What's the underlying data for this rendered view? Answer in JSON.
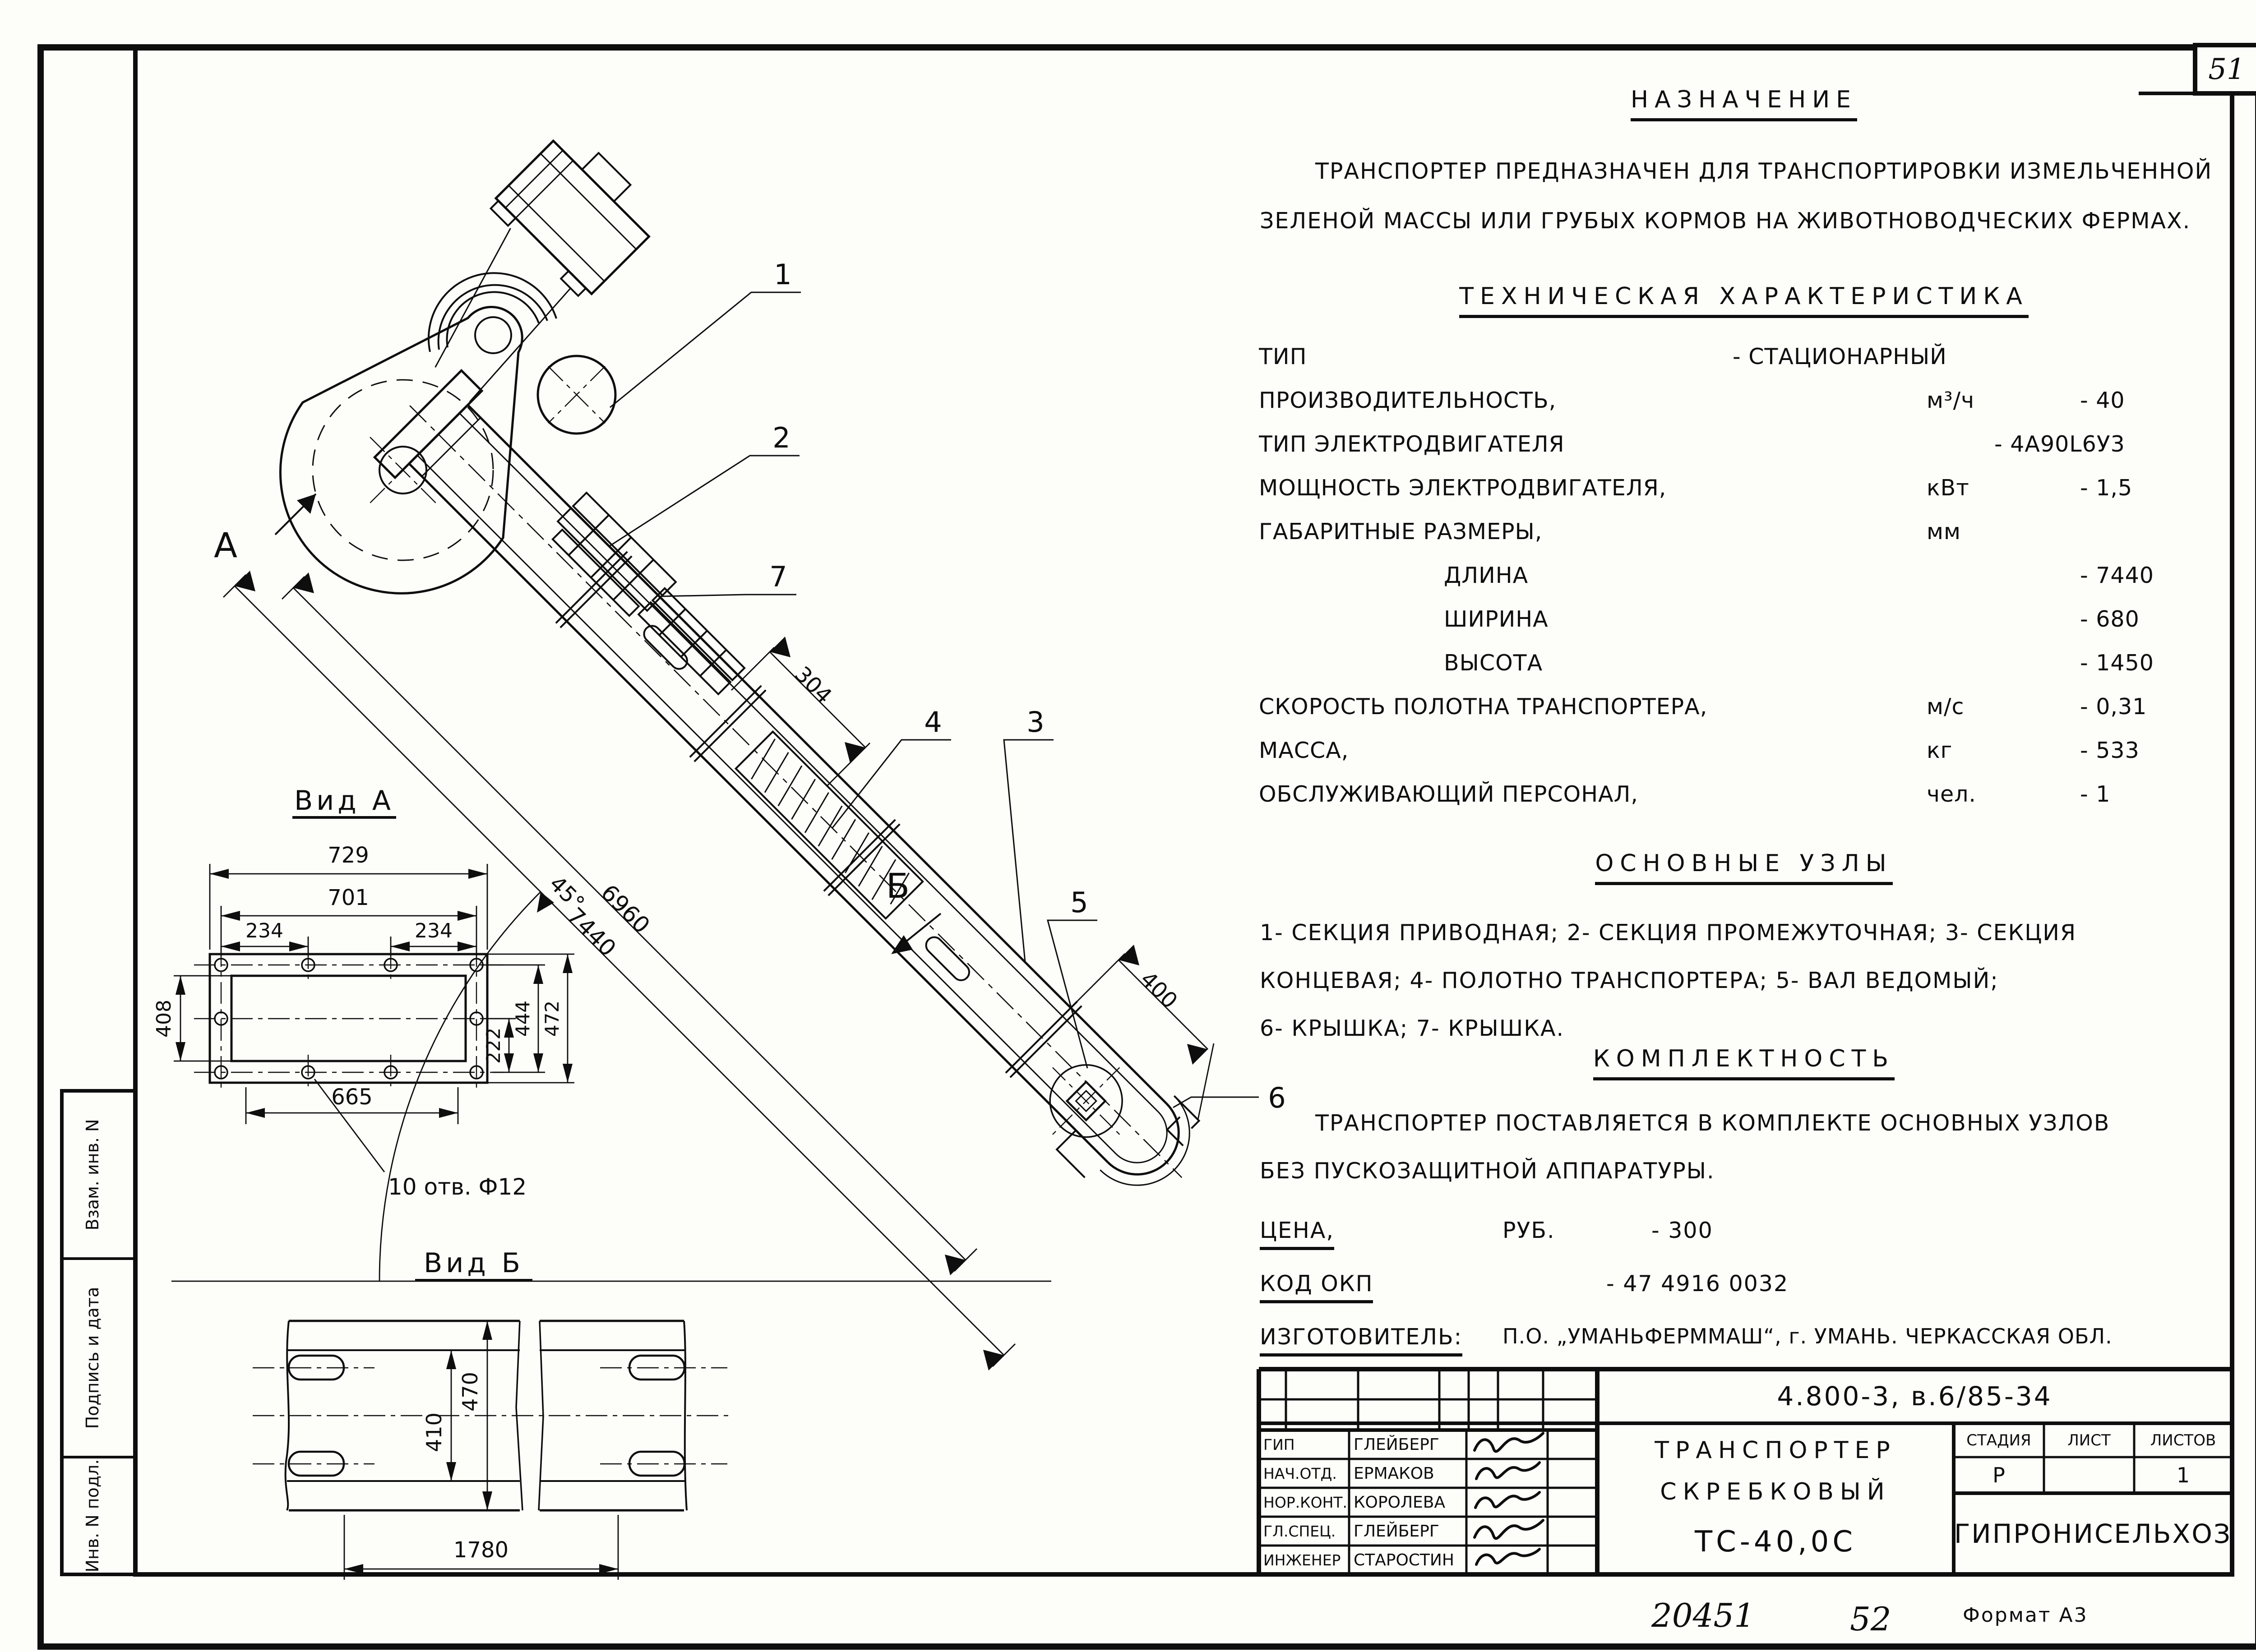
{
  "sheet": {
    "number": "51",
    "footer_left": "20451",
    "footer_mid": "52",
    "footer_format": "Формат А3"
  },
  "side_stamp": {
    "cell_top": "Взам. инв. N",
    "cell_mid": "Подпись и дата",
    "cell_bottom": "Инв. N подл."
  },
  "purpose": {
    "title": "НАЗНАЧЕНИЕ",
    "line1": "ТРАНСПОРТЕР  ПРЕДНАЗНАЧЕН  ДЛЯ  ТРАНСПОРТИРОВКИ  ИЗМЕЛЬЧЕННОЙ",
    "line2": "ЗЕЛЕНОЙ  МАССЫ  ИЛИ  ГРУБЫХ  КОРМОВ  НА ЖИВОТНОВОДЧЕСКИХ  ФЕРМАХ."
  },
  "specs": {
    "title": "ТЕХНИЧЕСКАЯ  ХАРАКТЕРИСТИКА",
    "rows": [
      {
        "label": "ТИП",
        "unit": "",
        "value": "- СТАЦИОНАРНЫЙ"
      },
      {
        "label": "ПРОИЗВОДИТЕЛЬНОСТЬ,",
        "unit": "м³/ч",
        "value": "- 40"
      },
      {
        "label": "ТИП  ЭЛЕКТРОДВИГАТЕЛЯ",
        "unit": "",
        "value": "- 4А90L6У3"
      },
      {
        "label": "МОЩНОСТЬ  ЭЛЕКТРОДВИГАТЕЛЯ,",
        "unit": "кВт",
        "value": "- 1,5"
      },
      {
        "label": "ГАБАРИТНЫЕ  РАЗМЕРЫ,",
        "unit": "мм",
        "value": ""
      },
      {
        "label": "ДЛИНА",
        "unit": "",
        "value": "- 7440"
      },
      {
        "label": "ШИРИНА",
        "unit": "",
        "value": "- 680"
      },
      {
        "label": "ВЫСОТА",
        "unit": "",
        "value": "- 1450"
      },
      {
        "label": "СКОРОСТЬ  ПОЛОТНА  ТРАНСПОРТЕРА,",
        "unit": "м/с",
        "value": "- 0,31"
      },
      {
        "label": "МАССА,",
        "unit": "кг",
        "value": "- 533"
      },
      {
        "label": "ОБСЛУЖИВАЮЩИЙ  ПЕРСОНАЛ,",
        "unit": "чел.",
        "value": "- 1"
      }
    ]
  },
  "units_section": {
    "title": "ОСНОВНЫЕ  УЗЛЫ",
    "line1": "1- СЕКЦИЯ  ПРИВОДНАЯ;   2- СЕКЦИЯ  ПРОМЕЖУТОЧНАЯ; 3- СЕКЦИЯ",
    "line2": "КОНЦЕВАЯ;   4- ПОЛОТНО  ТРАНСПОРТЕРА;  5- ВАЛ  ВЕДОМЫЙ;",
    "line3": "6- КРЫШКА;  7- КРЫШКА."
  },
  "completeness": {
    "title": "КОМПЛЕКТНОСТЬ",
    "line1": "ТРАНСПОРТЕР  ПОСТАВЛЯЕТСЯ  В  КОМПЛЕКТЕ  ОСНОВНЫХ  УЗЛОВ",
    "line2": "БЕЗ  ПУСКОЗАЩИТНОЙ  АППАРАТУРЫ."
  },
  "commerce": {
    "price_label": "ЦЕНА,",
    "price_unit": "РУБ.",
    "price_value": "- 300",
    "okp_label": "КОД  ОКП",
    "okp_value": "- 47 4916 0032",
    "maker_label": "ИЗГОТОВИТЕЛЬ:",
    "maker_value": "П.О. „УМАНЬФЕРММАШ“,  г. УМАНЬ. ЧЕРКАССКАЯ  ОБЛ."
  },
  "title_block": {
    "doc_number": "4.800-3, в.6/85-34",
    "product_line1": "ТРАНСПОРТЕР",
    "product_line2": "СКРЕБКОВЫЙ",
    "product_line3": "ТС-40,0С",
    "col_stage": "СТАДИЯ",
    "col_sheet": "ЛИСТ",
    "col_sheets": "ЛИСТОВ",
    "stage_value": "Р",
    "sheet_value": "",
    "sheets_value": "1",
    "org": "ГИПРОНИСЕЛЬХОЗ",
    "staff": [
      {
        "role": "ГИП",
        "name": "ГЛЕЙБЕРГ"
      },
      {
        "role": "НАЧ.ОТД.",
        "name": "ЕРМАКОВ"
      },
      {
        "role": "НОР.КОНТ.",
        "name": "КОРОЛЕВА"
      },
      {
        "role": "ГЛ.СПЕЦ.",
        "name": "ГЛЕЙБЕРГ"
      },
      {
        "role": "ИНЖЕНЕР",
        "name": "СТАРОСТИН"
      }
    ]
  },
  "drawing": {
    "main": {
      "dim_7440": "7440",
      "dim_6960": "6960",
      "dim_304": "304",
      "dim_400": "400",
      "angle": "45°",
      "label_a": "А",
      "label_b": "Б",
      "c1": "1",
      "c2": "2",
      "c3": "3",
      "c4": "4",
      "c5": "5",
      "c6": "6",
      "c7": "7"
    },
    "view_a": {
      "title": "Вид А",
      "dim_729": "729",
      "dim_701": "701",
      "dim_234l": "234",
      "dim_234r": "234",
      "dim_665": "665",
      "dim_408": "408",
      "dim_222": "222",
      "dim_444": "444",
      "dim_472": "472",
      "holes_note": "10 отв. Ф12"
    },
    "view_b": {
      "title": "Вид Б",
      "dim_470": "470",
      "dim_410": "410",
      "dim_1780": "1780"
    }
  }
}
